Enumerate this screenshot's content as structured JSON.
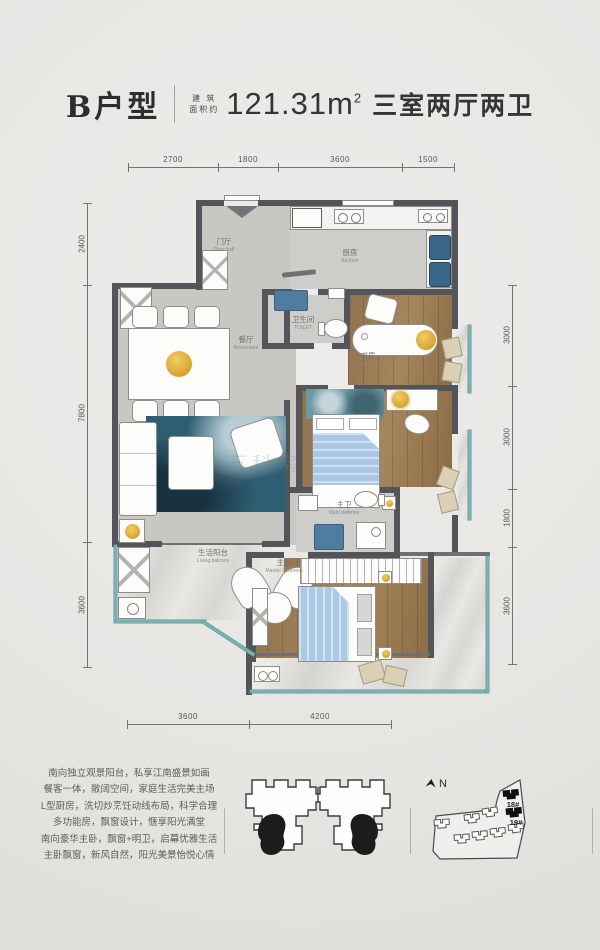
{
  "header": {
    "unit": "B户型",
    "area_label_l1": "建 筑",
    "area_label_l2": "面积约",
    "area_value": "121.31m",
    "area_exp": "2",
    "layout_desc": "三室两厅两卫"
  },
  "dims": {
    "top": [
      "2700",
      "1800",
      "3600",
      "1500"
    ],
    "left": [
      "2400",
      "7800",
      "3600"
    ],
    "right": [
      "3000",
      "3000",
      "1800",
      "3600"
    ],
    "bottom": [
      "3600",
      "4200"
    ]
  },
  "rooms": {
    "door_hall": {
      "cn": "门厅",
      "en": "Door hall"
    },
    "kitchen": {
      "cn": "厨房",
      "en": "Kitchen"
    },
    "toilet": {
      "cn": "卫生间",
      "en": "TOILET"
    },
    "study": {
      "cn": "书房",
      "en": "Study"
    },
    "dining": {
      "cn": "餐厅",
      "en": "Restaurant"
    },
    "master_bath": {
      "cn": "主卫",
      "en": "Main defense"
    },
    "living_balcony": {
      "cn": "生活阳台",
      "en": "Living balcony"
    },
    "master_bedroom": {
      "cn": "主卧",
      "en": "Master bedroom"
    }
  },
  "description_lines": [
    "南向独立观景阳台，私享江南盛景如画",
    "餐客一体，敞阔空间，家庭生活完美主场",
    "L型厨房，洗切炒烹饪动线布局，科学合理",
    "多功能房，飘窗设计，惬享阳光满堂",
    "南向豪华主卧，飘窗+明卫，启幕优雅生活",
    "主卧飘窗，新风自然，阳光美景怡悦心情"
  ],
  "site": {
    "north": "N",
    "b18": "18#",
    "b19": "19#"
  },
  "watermark": "万科房",
  "colors": {
    "wall": "#54555a",
    "glass_teal": "#79b0b2",
    "wood": "#97784f",
    "accent_yellow": "#e2ab3c",
    "appliance_blue": "#3a6787",
    "rug_blue": "#2e5e72",
    "bed_blue": "#a9c6e3",
    "highlight_black": "#1c1c1c"
  }
}
